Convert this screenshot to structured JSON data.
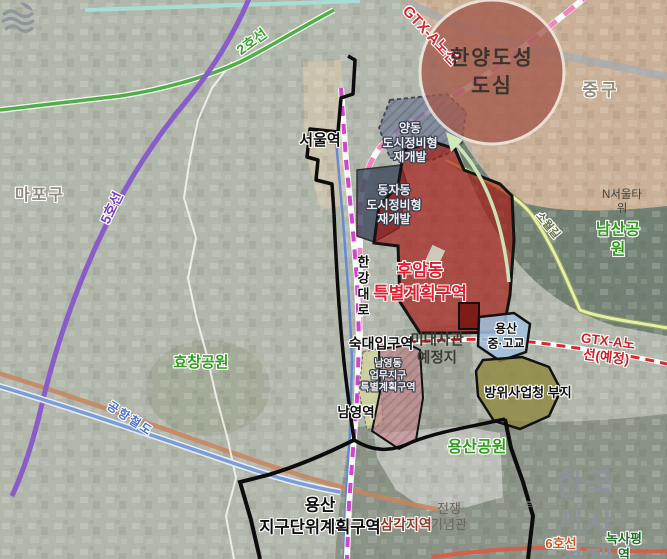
{
  "labels": {
    "line2": {
      "text": "2호선"
    },
    "gtx_a": {
      "text": "GTX-A노선"
    },
    "hanyang_doseong": {
      "text": "한양도성\n도심"
    },
    "junggu": {
      "text": "중구"
    },
    "mapogu": {
      "text": "마포구"
    },
    "line5": {
      "text": "5호선"
    },
    "seoul_station": {
      "text": "서울역"
    },
    "yangdong": {
      "text": "양동\n도시정비형\n재개발"
    },
    "dongjadong": {
      "text": "동자동\n도시정비형\n재개발"
    },
    "huamdong": {
      "text": "후암동\n특별계획구역"
    },
    "hangang_daero": {
      "text": "한강대로"
    },
    "n_seoul_tower": {
      "text": "N서울타워"
    },
    "namsan_park": {
      "text": "남산공원"
    },
    "sowolgil": {
      "text": "소월길"
    },
    "gtx_a_planned": {
      "text": "GTX-A노선(예정)"
    },
    "yongsan_school": {
      "text": "용산\n중·고교"
    },
    "dapa_site": {
      "text": "방위사업청 부지"
    },
    "sookdae_station": {
      "text": "숙대입구역"
    },
    "us_embassy": {
      "text": "미대사관\n예정지"
    },
    "namyeongdong": {
      "text": "남영동\n업무지구\n특별계획구역"
    },
    "namyeong_station": {
      "text": "남영역"
    },
    "hyochang_park": {
      "text": "효창공원"
    },
    "airport_railroad": {
      "text": "공항철도"
    },
    "yongsan_district": {
      "text": "용산\n지구단위계획구역"
    },
    "samgakji_station": {
      "text": "삼각지역"
    },
    "war_memorial": {
      "text": "전쟁\n기념관"
    },
    "yongsan_park": {
      "text": "용산공원"
    },
    "logo_tagline": {
      "text": "빠르고 신속한 정보"
    },
    "logo_name": {
      "text": "한국시사경제"
    },
    "line6": {
      "text": "6호선"
    },
    "noksapyeong_station": {
      "text": "녹사평역"
    }
  },
  "colors": {
    "line2_green": "#4fae46",
    "line4_magenta": "#d244cc",
    "line5_purple": "#8a5cc8",
    "line1_blue": "#5b85d6",
    "line6_orange": "#d2604a",
    "gtx_a_pink": "#ec86bc",
    "gtx_a_planned_red": "#d22a30",
    "airport_rail_blue": "#7c9cd8",
    "huam_zone_red": "#a51914",
    "hanyang_circle": "#a35a4d",
    "park_label_green": "#2f9e1c",
    "district_boundary_black": "#0c0c0c",
    "namsan_park_fill": "#6f7d70",
    "yongsan_park_fill": "#8b9386",
    "junggu_tan_fill": "#c9b096"
  }
}
